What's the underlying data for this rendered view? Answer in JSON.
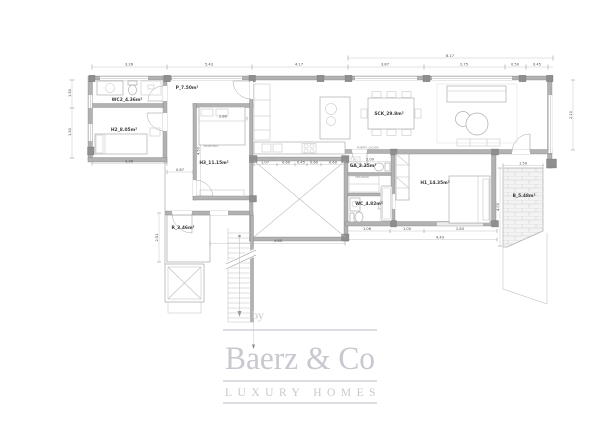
{
  "page": {
    "background": "#ffffff"
  },
  "colors": {
    "wall": "#b2b2b2",
    "pillar": "#8f8f8f",
    "plan_line": "#9a9a9a",
    "dim_text": "#4a4a4a",
    "room_text": "#3a3a3a",
    "brick_line": "#cfcfcf",
    "logo": "#c8c8d0"
  },
  "plan": {
    "rooms": [
      {
        "id": "wc2",
        "label": "WC2_4.36m²"
      },
      {
        "id": "h2",
        "label": "H2_8.05m²"
      },
      {
        "id": "p",
        "label": "P_7.50m²"
      },
      {
        "id": "h3",
        "label": "H3_11.15m²"
      },
      {
        "id": "sck",
        "label": "SCK_29.8m²"
      },
      {
        "id": "ga",
        "label": "GA_2.35m²"
      },
      {
        "id": "wc",
        "label": "WC_4.82m²"
      },
      {
        "id": "h1",
        "label": "H1_14.35m²"
      },
      {
        "id": "b",
        "label": "B_5.48m²"
      },
      {
        "id": "r",
        "label": "R_3.46m²"
      }
    ],
    "annotations": {
      "puerta": "PUERTA LACADA",
      "vestidor": "VESTIDOR",
      "maletero": "MALETERO"
    },
    "dims": [
      "3.26",
      "5.43",
      "4.17",
      "8.17",
      "3.87",
      "2.75",
      "0.50",
      "0.45",
      "1.50",
      "1.50",
      "3.26",
      "2.80",
      "4.50",
      "0.87",
      "2.51",
      "1.07",
      "0.60",
      "0.45",
      "0.60",
      "0.60",
      "4.60",
      "2.00",
      "1.06",
      "1.00",
      "2.83",
      "4.43",
      "1.50",
      "4.00",
      "2.10"
    ]
  },
  "logo": {
    "by": "by",
    "brand": "Baerz & Co",
    "tagline": "LUXURY HOMES"
  }
}
